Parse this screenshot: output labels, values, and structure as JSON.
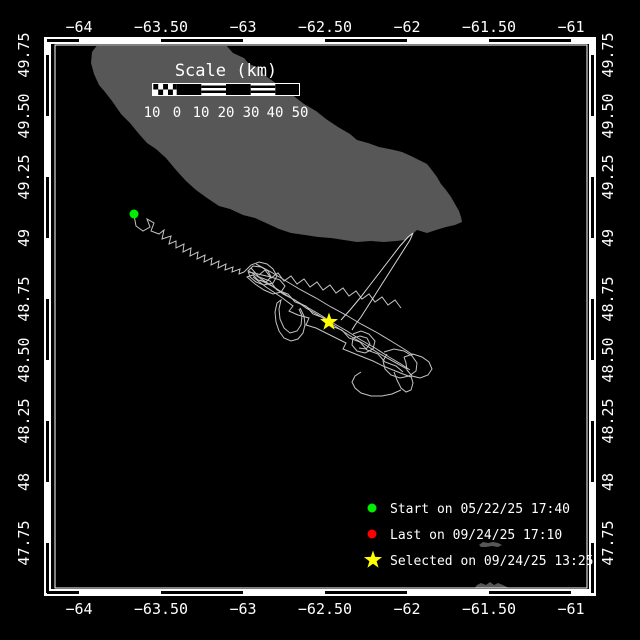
{
  "map": {
    "description": "Animal/vessel track map on black background with land in gray",
    "lon_range": [
      "−64.1",
      "−60.9"
    ],
    "lat_range": [
      "47.6",
      "49.8"
    ]
  },
  "axes": {
    "lon_labels": [
      "−64",
      "−63.50",
      "−63",
      "−62.50",
      "−62",
      "−61.50",
      "−61"
    ],
    "lat_labels": [
      "49.75",
      "49.50",
      "49.25",
      "49",
      "48.75",
      "48.50",
      "48.25",
      "48",
      "47.75"
    ]
  },
  "scale_bar": {
    "title": "Scale (km)",
    "tick_labels": [
      "10",
      "0",
      "10",
      "20",
      "30",
      "40",
      "50"
    ]
  },
  "legend": {
    "items": [
      {
        "marker": "circle",
        "color": "#00ee00",
        "label": "Start on 05/22/25 17:40"
      },
      {
        "marker": "circle",
        "color": "#ff0000",
        "label": "Last on 09/24/25 17:10"
      },
      {
        "marker": "star",
        "color": "#ffff00",
        "label": "Selected on 09/24/25 13:25"
      }
    ]
  },
  "colors": {
    "background": "#000000",
    "land": "#575757",
    "track": "#c4c4c4",
    "frame": "#ffffff",
    "start_marker": "#00ee00",
    "last_marker": "#ff0000",
    "selected_marker": "#ffff00"
  }
}
